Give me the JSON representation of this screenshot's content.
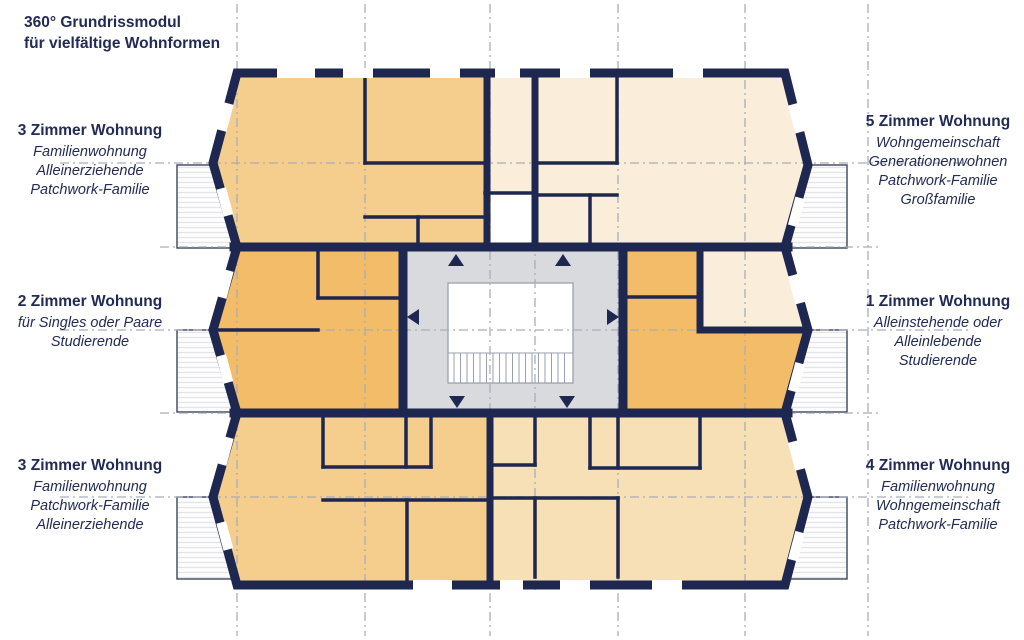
{
  "title": {
    "line1": "360° Grundrissmodul",
    "line2": "für vielfältige Wohnformen"
  },
  "labels": {
    "left": [
      {
        "heading": "3 Zimmer Wohnung",
        "lines": [
          "Familienwohnung",
          "Alleinerziehende",
          "Patchwork-Familie"
        ]
      },
      {
        "heading": "2 Zimmer Wohnung",
        "lines": [
          "für Singles oder Paare",
          "Studierende"
        ]
      },
      {
        "heading": "3 Zimmer Wohnung",
        "lines": [
          "Familienwohnung",
          "Patchwork-Familie",
          "Alleinerziehende"
        ]
      }
    ],
    "right": [
      {
        "heading": "5 Zimmer Wohnung",
        "lines": [
          "Wohngemeinschaft",
          "Generationenwohnen",
          "Patchwork-Familie",
          "Großfamilie"
        ]
      },
      {
        "heading": "1 Zimmer Wohnung",
        "lines": [
          "Alleinstehende oder",
          "Alleinlebende",
          "Studierende"
        ]
      },
      {
        "heading": "4 Zimmer Wohnung",
        "lines": [
          "Familienwohnung",
          "Wohngemeinschaft",
          "Patchwork-Familie"
        ]
      }
    ]
  },
  "plan": {
    "apartments": [
      {
        "name": "3 Zimmer Wohnung",
        "position": "top-left",
        "color": "#f5cd8c"
      },
      {
        "name": "5 Zimmer Wohnung",
        "position": "top-right",
        "color": "#faeedb"
      },
      {
        "name": "2 Zimmer Wohnung",
        "position": "middle-left",
        "color": "#f2bc69"
      },
      {
        "name": "1 Zimmer Wohnung",
        "position": "middle-right",
        "color": "#f2bc69"
      },
      {
        "name": "3 Zimmer Wohnung",
        "position": "bottom-left",
        "color": "#f5cd8c"
      },
      {
        "name": "4 Zimmer Wohnung",
        "position": "bottom-right",
        "color": "#f7e0b5"
      }
    ],
    "core_color": "#d8dade",
    "wall_color": "#1d2750",
    "grid_color": "#a9adb6",
    "text_color": "#222b55"
  }
}
